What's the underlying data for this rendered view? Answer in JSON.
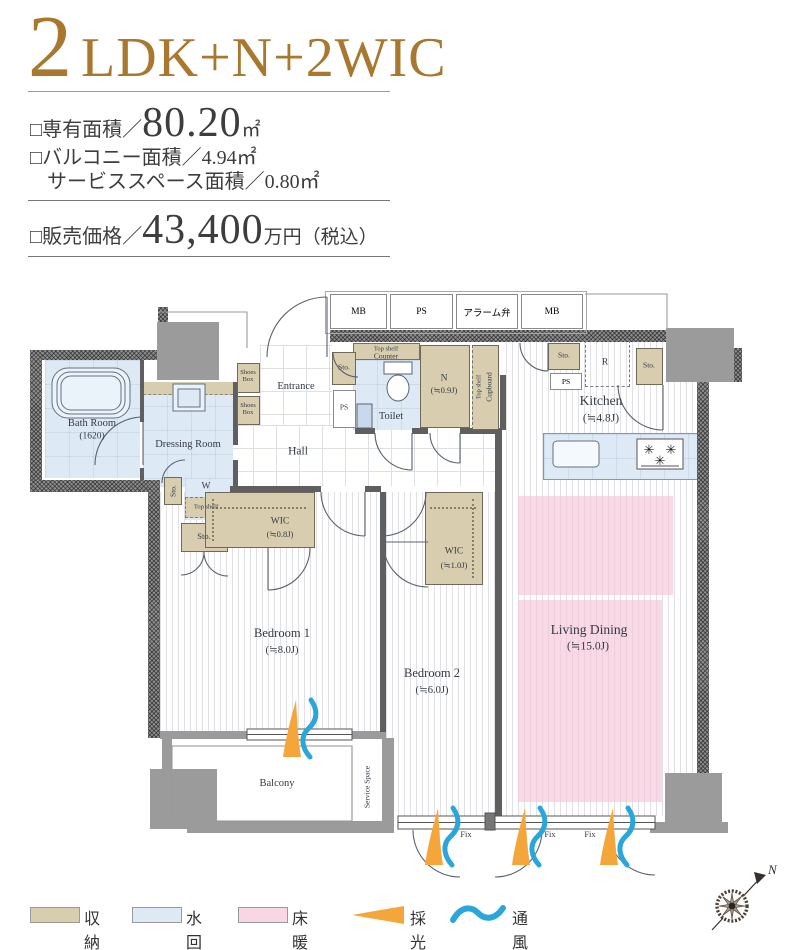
{
  "header": {
    "count": "2",
    "layout": "LDK+N+2WIC"
  },
  "specs": {
    "area_label": "□専有面積／",
    "area_value": "80.20",
    "area_unit": "㎡",
    "balcony_line": "□バルコニー面積／4.94㎡",
    "service_line": "サービススペース面積／0.80㎡",
    "price_label": "□販売価格／",
    "price_value": "43,400",
    "price_unit": "万円（税込）"
  },
  "utility_row": {
    "mb1": "MB",
    "ps": "PS",
    "alarm": "アラーム弁",
    "mb2": "MB"
  },
  "rooms": {
    "bath": {
      "name": "Bath Room",
      "size": "(1620)"
    },
    "dressing": {
      "name": "Dressing Room"
    },
    "entrance": {
      "name": "Entrance"
    },
    "hall": {
      "name": "Hall"
    },
    "toilet": {
      "name": "Toilet"
    },
    "n": {
      "name": "N",
      "size": "(≒0.9J)"
    },
    "kitchen": {
      "name": "Kitchen",
      "size": "(≒4.8J)"
    },
    "living": {
      "name": "Living Dining",
      "size": "(≒15.0J)"
    },
    "bedroom1": {
      "name": "Bedroom 1",
      "size": "(≒8.0J)"
    },
    "bedroom2": {
      "name": "Bedroom 2",
      "size": "(≒6.0J)"
    },
    "wic_small": {
      "name": "WIC",
      "size": "(≒0.8J)"
    },
    "wic_large": {
      "name": "WIC",
      "size": "(≒1.0J)"
    },
    "balcony": {
      "name": "Balcony"
    },
    "service_space": {
      "name": "Service Space"
    }
  },
  "fixtures": {
    "shoes_box": "Shoes Box",
    "sto": "Sto.",
    "ps": "PS",
    "w": "W",
    "r": "R",
    "top_shelf": "Top shelf",
    "counter": "Counter",
    "cupboard": "Cupboard",
    "fix": "Fix"
  },
  "legend": {
    "storage": "収納",
    "water": "水回り",
    "floor_heating": "床暖房",
    "daylight": "採光",
    "ventilation": "通風"
  },
  "compass": {
    "north": "N"
  },
  "icons": {
    "burner": "✳"
  },
  "colors": {
    "accent_brown": "#a9782f",
    "storage_beige": "#d8cdae",
    "water_blue": "#dde9f5",
    "heating_pink": "#f8d6e3",
    "daylight_orange": "#f4a63b",
    "ventilation_blue": "#2ba6da",
    "wall_gray": "#8f8f8f",
    "line_dark": "#555555",
    "text_dark": "#333333"
  }
}
